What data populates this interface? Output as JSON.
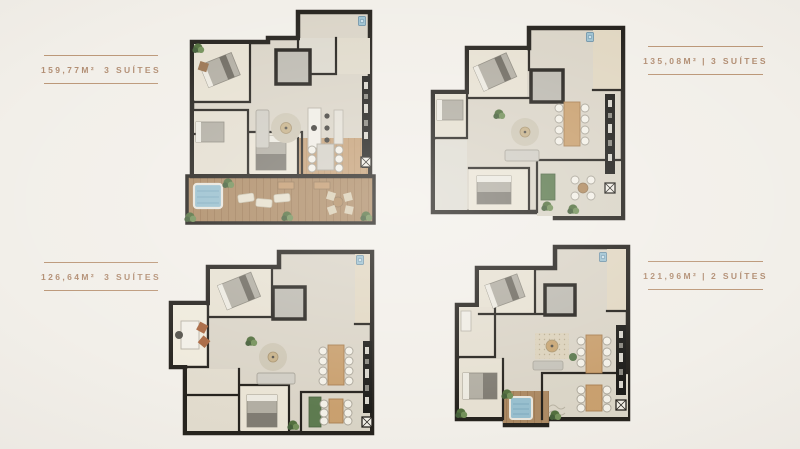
{
  "page": {
    "background_color": "#F2EFE9",
    "text_color": "#B28E73",
    "rule_color": "#BC9879"
  },
  "plans": [
    {
      "name": "floorplan-1",
      "area": "159,77M²",
      "separator": "",
      "suites": "3 SUÍTES",
      "label_position": "left"
    },
    {
      "name": "floorplan-2",
      "area": "135,08M²",
      "separator": "|",
      "suites": "3 SUÍTES",
      "label_position": "right"
    },
    {
      "name": "floorplan-3",
      "area": "126,64M²",
      "separator": "",
      "suites": "3 SUÍTES",
      "label_position": "left"
    },
    {
      "name": "floorplan-4",
      "area": "121,96M²",
      "separator": "|",
      "suites": "2 SUÍTES",
      "label_position": "right"
    }
  ],
  "palette": {
    "wall": "#26231E",
    "floor": "#DAD4C7",
    "floor_light": "#E7E1D2",
    "wood_deck": "#AC8A64",
    "wood_interior": "#C39A6E",
    "table_wood": "#C9A06F",
    "hot_tub_blue": "#98BFCE",
    "plant_green": "#53703E",
    "accent_green": "#5E7B50",
    "furniture_gray": "#B2AEA3",
    "appliance_black": "#1F1E1B"
  }
}
